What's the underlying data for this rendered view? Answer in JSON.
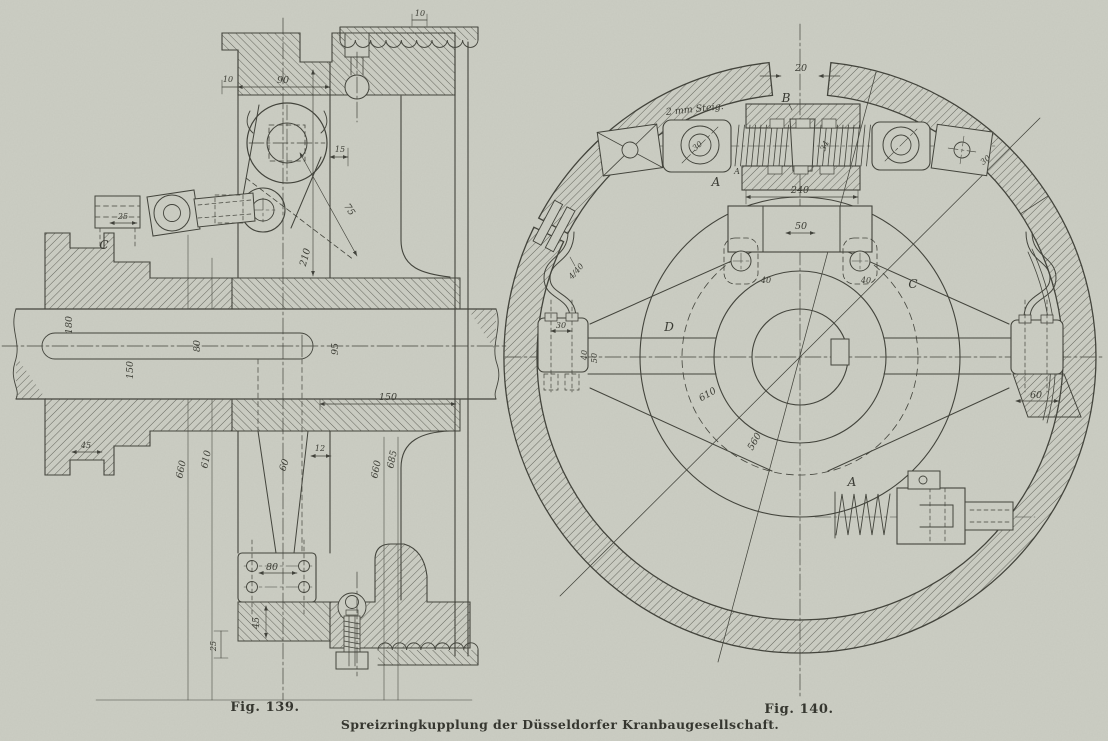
{
  "page": {
    "background": "#cbcdc3",
    "ink": "#41423a"
  },
  "caption": {
    "fig139_label": "Fig. 139.",
    "fig140_label": "Fig. 140.",
    "title": "Spreizringkupplung der Düsseldorfer Kranbaugesellschaft."
  },
  "fig139": {
    "dims": {
      "scallop_pitch": "10",
      "plate_width": "90",
      "step_left": "10",
      "ring_gap": "15",
      "lever_arm": "75",
      "rod_guide": "25",
      "plate_height": "210",
      "shaft_d_left": "180",
      "shaft_d_mid": "150",
      "keyway": "80",
      "shaft_d_right": "95",
      "step_bottom": "45",
      "dia_outer_left": "660",
      "dia_inner_left": "610",
      "arm_rod": "60",
      "lip": "12",
      "flange": "150",
      "dia_outer_right": "660",
      "dia_rim_right": "685",
      "bolt_plate": "80",
      "hub_lip": "45",
      "hub_edge": "25"
    },
    "letters": {
      "c": "C"
    }
  },
  "fig140": {
    "dims": {
      "ring_gap": "20",
      "eye_left": "30",
      "spindle": "34",
      "anchor_right": "30",
      "bracket_width": "240",
      "bracket_inner": "50",
      "strap_left": "40",
      "strap_right": "40",
      "dia_inner": "610",
      "dia_hub": "560",
      "leaf_spring": "4/40",
      "block_left_top": "30",
      "block_left_a": "40",
      "block_left_b": "50",
      "block_right": "60"
    },
    "letters": {
      "a1": "A",
      "a2": "A",
      "a3": "A",
      "b": "B",
      "c": "C",
      "d": "D"
    },
    "annotations": {
      "steig": "2 mm Steig."
    }
  }
}
